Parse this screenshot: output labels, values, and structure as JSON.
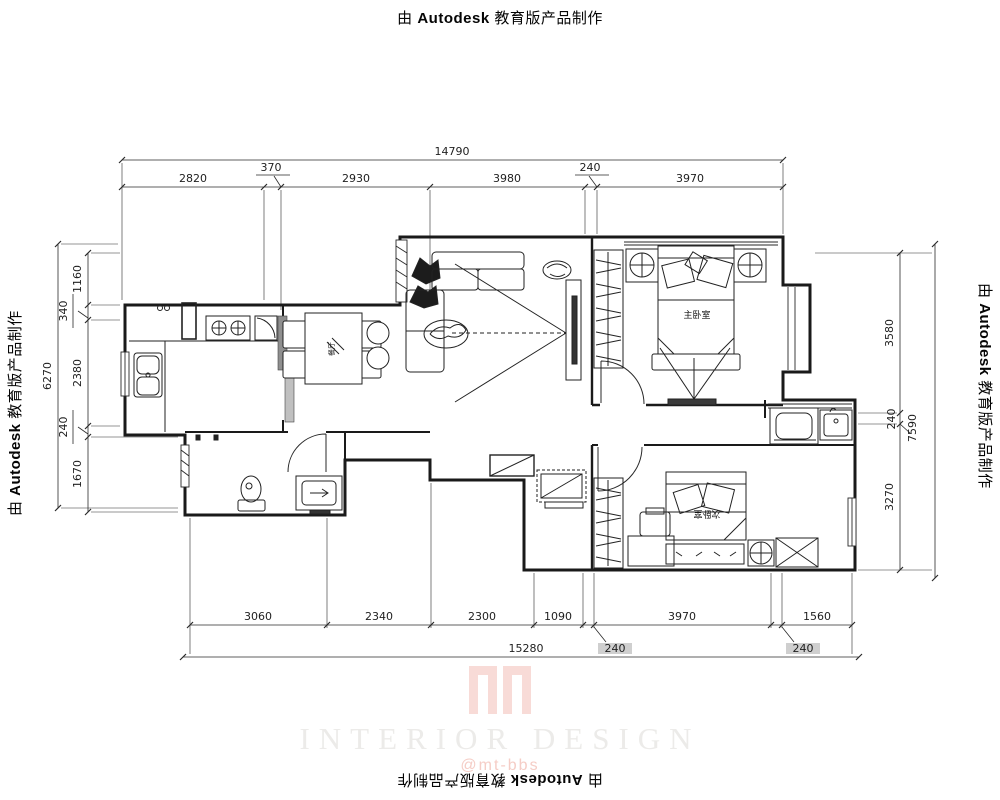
{
  "stamp": {
    "prefix": "由",
    "brand": "Autodesk",
    "suffix": "教育版产品制作"
  },
  "watermark": {
    "title": "INTERIOR DESIGN",
    "handle": "@mt-bbs"
  },
  "rooms": {
    "master": "主卧室",
    "second": "次卧室",
    "dining": "餐厅"
  },
  "dims": {
    "top": {
      "overall": "14790",
      "segments": [
        "2820",
        "370",
        "2930",
        "3980",
        "240",
        "3970"
      ]
    },
    "bottom": {
      "overall": "15280",
      "segments": [
        "3060",
        "2340",
        "2300",
        "1090",
        "240",
        "3970",
        "240",
        "1560"
      ]
    },
    "left": {
      "overall": "6270",
      "segments": [
        "1160",
        "340",
        "2380",
        "240",
        "1670"
      ]
    },
    "right": {
      "overall": "7590",
      "segments": [
        "3580",
        "240",
        "3270"
      ]
    }
  },
  "colors": {
    "line": "#1a1a1a",
    "watermark_pink": "#f3bdb6",
    "dim_highlight": "#cfcfcf"
  }
}
